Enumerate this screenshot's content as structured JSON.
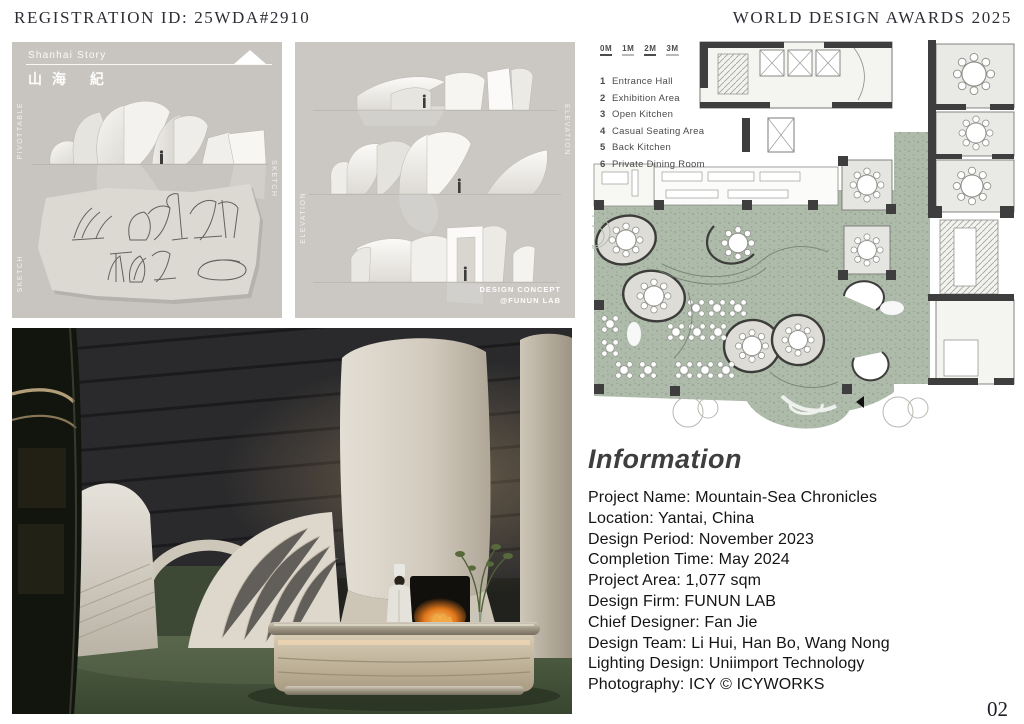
{
  "header": {
    "registration_id": "REGISTRATION ID: 25WDA#2910",
    "award_title": "WORLD DESIGN AWARDS 2025"
  },
  "concept_panel": {
    "story_title": "Shanhai Story",
    "story_title_cn": "山海 紀",
    "label_left_top": "PIVOTTABLE",
    "label_left_bottom": "SKETCH",
    "label_right": "SKETCH"
  },
  "elevation_panel": {
    "label_right": "ELEVATION",
    "label_left": "ELEVATION",
    "credit_line1": "DESIGN CONCEPT",
    "credit_line2": "@FUNUN LAB"
  },
  "floor_plan": {
    "scale_labels": [
      "0M",
      "1M",
      "2M",
      "3M"
    ],
    "legend": [
      {
        "num": "1",
        "label": "Entrance Hall"
      },
      {
        "num": "2",
        "label": "Exhibition Area"
      },
      {
        "num": "3",
        "label": "Open Kitchen"
      },
      {
        "num": "4",
        "label": "Casual Seating Area"
      },
      {
        "num": "5",
        "label": "Back Kitchen"
      },
      {
        "num": "6",
        "label": "Private Dining Room"
      }
    ]
  },
  "information": {
    "heading": "Information",
    "rows": [
      "Project Name: Mountain-Sea Chronicles",
      "Location: Yantai, China",
      "Design Period: November 2023",
      "Completion Time: May 2024",
      "Project Area: 1,077 sqm",
      "Design Firm: FUNUN LAB",
      "Chief Designer: Fan Jie",
      "Design Team: Li Hui, Han Bo, Wang Nong",
      "Lighting Design: Uniimport Technology",
      "Photography: ICY © ICYWORKS"
    ]
  },
  "page_number": "02",
  "colors": {
    "plan_green": "#afbcab",
    "plan_wall": "#3e3e3e",
    "photo_floor_green": "#4c5c41",
    "panel_gray": "#c8c5c0",
    "fire_orange": "#e87a1e"
  }
}
